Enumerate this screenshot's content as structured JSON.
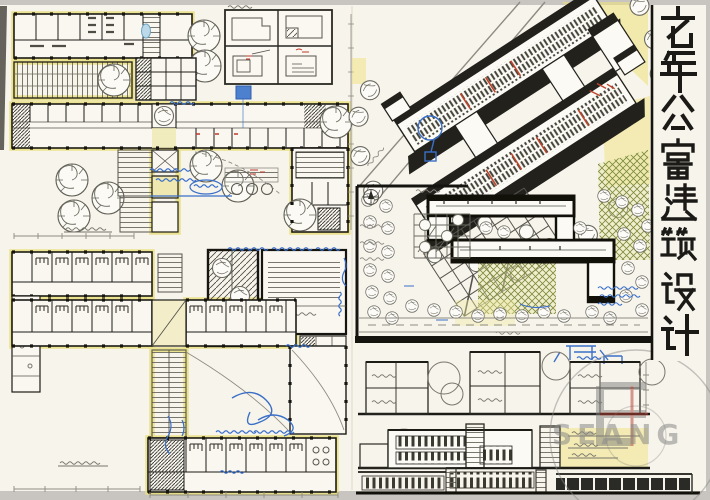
{
  "sheet": {
    "title": "老年公寓建筑设计",
    "title_characters": [
      "老",
      "年",
      "公",
      "寓",
      "建",
      "筑",
      "设",
      "计"
    ],
    "medium": "hand-drawn ink, marker and highlighter architectural presentation board"
  },
  "panels": {
    "floor_plan_upper": {
      "caption": "一层平面图"
    },
    "floor_plan_lower": {
      "caption": "二层平面图"
    },
    "unit_details": {
      "caption": "户型放大图",
      "cells": 4
    },
    "axonometric": {
      "caption": "鸟瞰图"
    },
    "site_plan": {
      "caption": "总平面图"
    },
    "section": {
      "caption": "剖面图"
    },
    "elevation_main": {
      "caption": "立面图"
    },
    "elevation_street": {
      "caption": "沿街立面图"
    }
  },
  "annotations": {
    "pen_color": "#3a6fc8",
    "note": "handwritten blue-pen review marks (illegible scribbles)"
  },
  "watermark": {
    "letters": "SEANG"
  },
  "palette": {
    "paper": "#f7f4ec",
    "highlighter_yellow": "#eadf7f",
    "ink": "#1c1b16",
    "pencil": "#8d8b82",
    "pen_blue": "#3a6fc8",
    "accent_red": "#c0392b",
    "foliage_olive": "#7c8a3e",
    "photo_margin": "#c8c5c0"
  }
}
